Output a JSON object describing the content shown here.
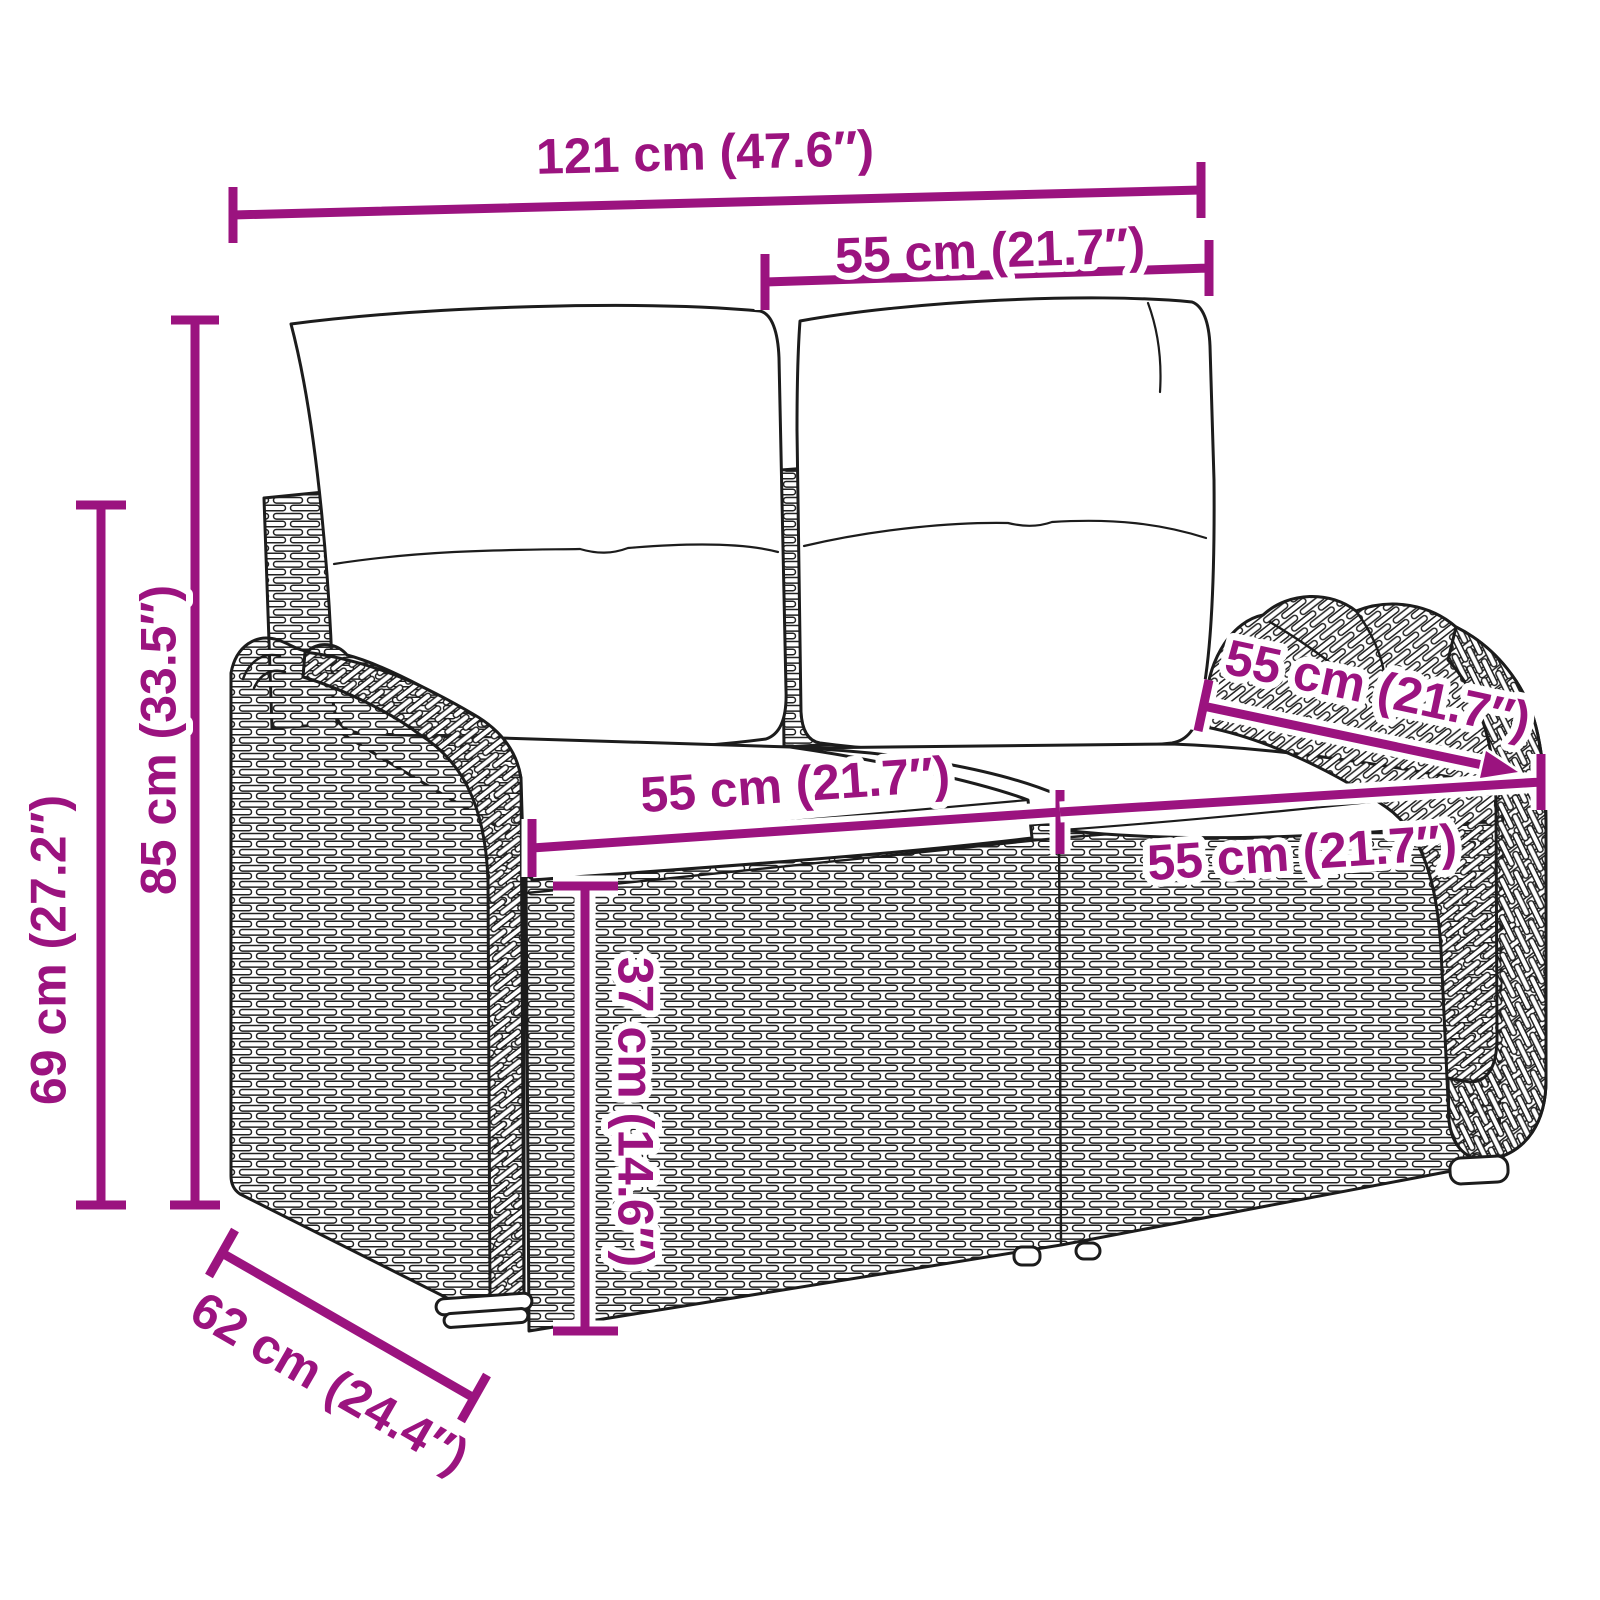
{
  "diagram": {
    "type": "product-dimension-diagram",
    "subject": "poly rattan 2-seater garden bench with back and seat cushions",
    "background_color": "#ffffff",
    "accent_color": "#9b137f",
    "lineart_color": "#1c1c1c",
    "units": [
      "cm",
      "inches"
    ]
  },
  "dimensions": {
    "overall_width": {
      "name": "overall width",
      "label": "121 cm (47.6″)",
      "cm": 121,
      "inches": 47.6
    },
    "back_cushion_width": {
      "name": "back cushion width",
      "label": "55 cm (21.7″)",
      "cm": 55,
      "inches": 21.7
    },
    "total_height": {
      "name": "total height",
      "label": "85 cm (33.5″)",
      "cm": 85,
      "inches": 33.5
    },
    "back_height": {
      "name": "back panel height",
      "label": "69 cm (27.2″)",
      "cm": 69,
      "inches": 27.2
    },
    "overall_depth": {
      "name": "overall depth",
      "label": "62 cm (24.4″)",
      "cm": 62,
      "inches": 24.4
    },
    "seat_height": {
      "name": "seat height",
      "label": "37 cm (14.6″)",
      "cm": 37,
      "inches": 14.6
    },
    "seat_width_left": {
      "name": "left seat width",
      "label": "55 cm (21.7″)",
      "cm": 55,
      "inches": 21.7
    },
    "seat_width_right": {
      "name": "right seat width",
      "label": "55 cm (21.7″)",
      "cm": 55,
      "inches": 21.7
    },
    "seat_depth": {
      "name": "seat depth",
      "label": "55 cm (21.7″)",
      "cm": 55,
      "inches": 21.7
    }
  }
}
